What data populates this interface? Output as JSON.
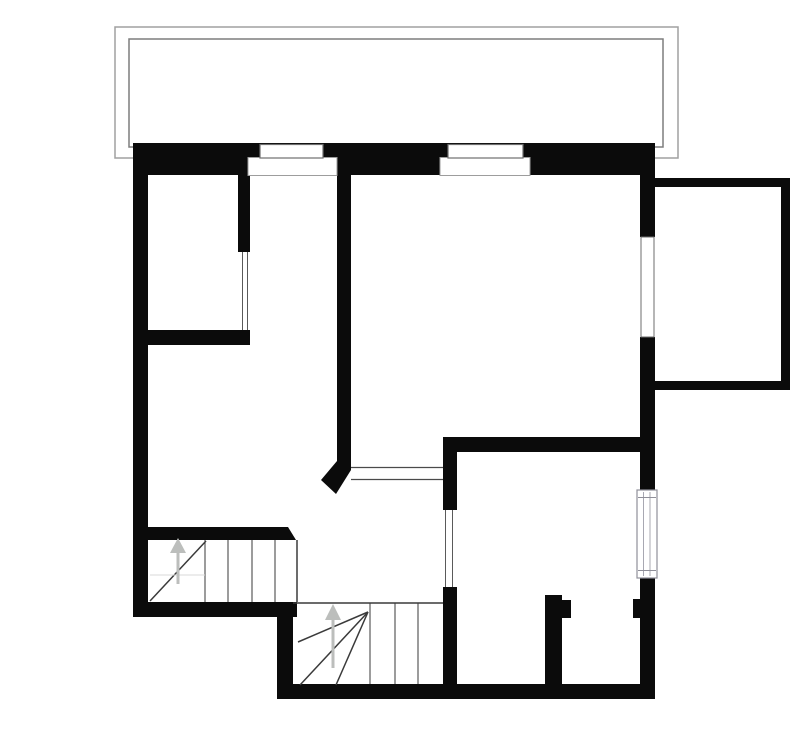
{
  "canvas": {
    "width": 800,
    "height": 736,
    "background": "#ffffff"
  },
  "colors": {
    "wall": "#0b0b0b",
    "white": "#ffffff",
    "terrace_outer": "#a0a0a0",
    "terrace_inner": "#7d7d7d",
    "window_line": "#6e6e6e",
    "recess_line": "#9d9d9d",
    "opening_line": "#5a5a5a",
    "door_line": "#4a4a4a",
    "tread": "#3a3a3a",
    "faint": "#d8d8d8",
    "arrow": "#bcbebc",
    "radiator_border": "#8f8f99",
    "radiator_line": "#a8a8b2"
  },
  "elements": [
    {
      "type": "rect",
      "name": "terrace-outer-rect",
      "x": 115,
      "y": 27,
      "w": 563,
      "h": 131,
      "fill": "none",
      "stroke": "terrace_outer",
      "sw": 1.5
    },
    {
      "type": "rect",
      "name": "terrace-inner-rect",
      "x": 129,
      "y": 39,
      "w": 534,
      "h": 108,
      "fill": "none",
      "stroke": "terrace_inner",
      "sw": 1.5
    },
    {
      "type": "rect",
      "name": "top-wall",
      "x": 133,
      "y": 143,
      "w": 522,
      "h": 32,
      "fill": "wall"
    },
    {
      "type": "rect",
      "name": "left-wall",
      "x": 133,
      "y": 143,
      "w": 15,
      "h": 474,
      "fill": "wall"
    },
    {
      "type": "rect",
      "name": "bottom-left-wall",
      "x": 133,
      "y": 602,
      "w": 164,
      "h": 15,
      "fill": "wall"
    },
    {
      "type": "rect",
      "name": "stair-step-wall",
      "x": 277,
      "y": 602,
      "w": 16,
      "h": 97,
      "fill": "wall"
    },
    {
      "type": "rect",
      "name": "bottom-wall",
      "x": 277,
      "y": 684,
      "w": 378,
      "h": 15,
      "fill": "wall"
    },
    {
      "type": "rect",
      "name": "right-wall-upper",
      "x": 640,
      "y": 143,
      "w": 15,
      "h": 94,
      "fill": "wall"
    },
    {
      "type": "rect",
      "name": "right-wall-mid",
      "x": 640,
      "y": 337,
      "w": 15,
      "h": 153,
      "fill": "wall"
    },
    {
      "type": "rect",
      "name": "right-wall-lower",
      "x": 640,
      "y": 578,
      "w": 15,
      "h": 121,
      "fill": "wall"
    },
    {
      "type": "rect",
      "name": "balcony-top-wall",
      "x": 653,
      "y": 178,
      "w": 137,
      "h": 9,
      "fill": "wall"
    },
    {
      "type": "rect",
      "name": "balcony-right-wall",
      "x": 781,
      "y": 178,
      "w": 9,
      "h": 212,
      "fill": "wall"
    },
    {
      "type": "rect",
      "name": "balcony-bottom-wall",
      "x": 653,
      "y": 381,
      "w": 137,
      "h": 9,
      "fill": "wall"
    },
    {
      "type": "rect",
      "name": "bedroom-divider-wall",
      "x": 238,
      "y": 158,
      "w": 12,
      "h": 94,
      "fill": "wall"
    },
    {
      "type": "rect",
      "name": "bedroom-bottom-wall",
      "x": 148,
      "y": 330,
      "w": 102,
      "h": 15,
      "fill": "wall"
    },
    {
      "type": "rect",
      "name": "center-wall",
      "x": 337,
      "y": 143,
      "w": 14,
      "h": 324,
      "fill": "wall"
    },
    {
      "type": "rect",
      "name": "room2-top-wall",
      "x": 443,
      "y": 437,
      "w": 212,
      "h": 15,
      "fill": "wall"
    },
    {
      "type": "rect",
      "name": "room2-left-wall-upper",
      "x": 443,
      "y": 437,
      "w": 14,
      "h": 73,
      "fill": "wall"
    },
    {
      "type": "rect",
      "name": "room2-left-wall-lower",
      "x": 443,
      "y": 587,
      "w": 14,
      "h": 112,
      "fill": "wall"
    },
    {
      "type": "rect",
      "name": "stair-side-wall",
      "x": 148,
      "y": 527,
      "w": 130,
      "h": 13,
      "fill": "wall"
    },
    {
      "type": "rect",
      "name": "room2-stub-wall",
      "x": 545,
      "y": 595,
      "w": 17,
      "h": 101,
      "fill": "wall"
    },
    {
      "type": "rect",
      "name": "room2-stub-notch",
      "x": 562,
      "y": 600,
      "w": 9,
      "h": 18,
      "fill": "wall"
    },
    {
      "type": "rect",
      "name": "right-wall-stub",
      "x": 633,
      "y": 599,
      "w": 9,
      "h": 19,
      "fill": "wall"
    },
    {
      "type": "polygon",
      "name": "center-wall-tip",
      "points": "337,461 351,461 351,470 336,494 321,480",
      "fill": "wall"
    },
    {
      "type": "polygon",
      "name": "stair-side-wall-end",
      "points": "278,527 288,527 296,540 278,540",
      "fill": "wall"
    },
    {
      "type": "rect",
      "name": "window1-recess",
      "x": 248,
      "y": 157.5,
      "w": 89,
      "h": 18,
      "fill": "white",
      "stroke": "recess_line",
      "sw": 1
    },
    {
      "type": "rect",
      "name": "window1",
      "x": 260,
      "y": 144.5,
      "w": 63,
      "h": 13.5,
      "fill": "white",
      "stroke": "window_line",
      "sw": 1.2
    },
    {
      "type": "rect",
      "name": "window2-recess",
      "x": 440,
      "y": 157.5,
      "w": 90,
      "h": 18,
      "fill": "white",
      "stroke": "recess_line",
      "sw": 1
    },
    {
      "type": "rect",
      "name": "window2",
      "x": 448,
      "y": 144.5,
      "w": 75,
      "h": 13.5,
      "fill": "white",
      "stroke": "window_line",
      "sw": 1.2
    },
    {
      "type": "rect",
      "name": "window3",
      "x": 641,
      "y": 237,
      "w": 13,
      "h": 100,
      "fill": "white",
      "stroke": "window_line",
      "sw": 1
    },
    {
      "type": "rect",
      "name": "radiator-window",
      "x": 637,
      "y": 490,
      "w": 20,
      "h": 88,
      "fill": "white",
      "stroke": "radiator_border",
      "sw": 1.2
    },
    {
      "type": "line",
      "name": "radiator-line-left",
      "x1": 643.5,
      "y1": 492,
      "x2": 643.5,
      "y2": 576,
      "stroke": "radiator_line",
      "sw": 1
    },
    {
      "type": "line",
      "name": "radiator-line-right",
      "x1": 650,
      "y1": 492,
      "x2": 650,
      "y2": 576,
      "stroke": "radiator_line",
      "sw": 1
    },
    {
      "type": "line",
      "name": "radiator-cap-top",
      "x1": 638,
      "y1": 497.5,
      "x2": 656,
      "y2": 497.5,
      "stroke": "radiator_border",
      "sw": 1
    },
    {
      "type": "line",
      "name": "radiator-cap-bottom",
      "x1": 638,
      "y1": 570.5,
      "x2": 656,
      "y2": 570.5,
      "stroke": "radiator_border",
      "sw": 1
    },
    {
      "type": "line",
      "name": "glazing-line-1",
      "x1": 242.5,
      "y1": 252,
      "x2": 242.5,
      "y2": 330,
      "stroke": "opening_line",
      "sw": 1
    },
    {
      "type": "line",
      "name": "glazing-line-2",
      "x1": 247.5,
      "y1": 252,
      "x2": 247.5,
      "y2": 330,
      "stroke": "opening_line",
      "sw": 1
    },
    {
      "type": "line",
      "name": "room2-opening-line-1",
      "x1": 445.5,
      "y1": 510,
      "x2": 445.5,
      "y2": 587,
      "stroke": "opening_line",
      "sw": 1
    },
    {
      "type": "line",
      "name": "room2-opening-line-2",
      "x1": 452.5,
      "y1": 510,
      "x2": 452.5,
      "y2": 587,
      "stroke": "opening_line",
      "sw": 1
    },
    {
      "type": "line",
      "name": "door-opening-line-top",
      "x1": 351,
      "y1": 467.5,
      "x2": 443,
      "y2": 467.5,
      "stroke": "door_line",
      "sw": 1.2
    },
    {
      "type": "line",
      "name": "door-opening-line-bottom",
      "x1": 351,
      "y1": 479.5,
      "x2": 443,
      "y2": 479.5,
      "stroke": "door_line",
      "sw": 1.2
    },
    {
      "type": "line",
      "name": "stair1-tread-1",
      "x1": 205,
      "y1": 540,
      "x2": 205,
      "y2": 602,
      "stroke": "tread",
      "sw": 1
    },
    {
      "type": "line",
      "name": "stair1-tread-2",
      "x1": 228,
      "y1": 540,
      "x2": 228,
      "y2": 602,
      "stroke": "tread",
      "sw": 1
    },
    {
      "type": "line",
      "name": "stair1-tread-3",
      "x1": 252,
      "y1": 540,
      "x2": 252,
      "y2": 602,
      "stroke": "tread",
      "sw": 1
    },
    {
      "type": "line",
      "name": "stair1-tread-4",
      "x1": 275,
      "y1": 540,
      "x2": 275,
      "y2": 602,
      "stroke": "tread",
      "sw": 1
    },
    {
      "type": "line",
      "name": "stair1-edge",
      "x1": 297,
      "y1": 540,
      "x2": 297,
      "y2": 602,
      "stroke": "tread",
      "sw": 1.5
    },
    {
      "type": "line",
      "name": "stair1-diagonal",
      "x1": 150,
      "y1": 601,
      "x2": 206,
      "y2": 541,
      "stroke": "tread",
      "sw": 1.5
    },
    {
      "type": "line",
      "name": "stair1-faint-line",
      "x1": 150,
      "y1": 575,
      "x2": 205,
      "y2": 575,
      "stroke": "faint",
      "sw": 1
    },
    {
      "type": "line",
      "name": "stair1-arrow-shaft",
      "x1": 178,
      "y1": 584,
      "x2": 178,
      "y2": 551,
      "stroke": "arrow",
      "sw": 3
    },
    {
      "type": "polygon",
      "name": "stair1-arrow-head",
      "points": "170,553 186,553 178,538",
      "fill": "arrow"
    },
    {
      "type": "line",
      "name": "stair2-top-edge",
      "x1": 293,
      "y1": 603,
      "x2": 443,
      "y2": 603,
      "stroke": "tread",
      "sw": 1.5
    },
    {
      "type": "line",
      "name": "stair2-tread-1",
      "x1": 370,
      "y1": 603,
      "x2": 370,
      "y2": 684,
      "stroke": "tread",
      "sw": 1
    },
    {
      "type": "line",
      "name": "stair2-tread-2",
      "x1": 395,
      "y1": 603,
      "x2": 395,
      "y2": 684,
      "stroke": "tread",
      "sw": 1
    },
    {
      "type": "line",
      "name": "stair2-tread-3",
      "x1": 418,
      "y1": 603,
      "x2": 418,
      "y2": 684,
      "stroke": "tread",
      "sw": 1
    },
    {
      "type": "line",
      "name": "stair2-winder-line-1",
      "x1": 368,
      "y1": 612,
      "x2": 298,
      "y2": 642,
      "stroke": "tread",
      "sw": 1.5
    },
    {
      "type": "line",
      "name": "stair2-winder-line-2",
      "x1": 368,
      "y1": 612,
      "x2": 300,
      "y2": 685,
      "stroke": "tread",
      "sw": 1.5
    },
    {
      "type": "line",
      "name": "stair2-winder-line-3",
      "x1": 368,
      "y1": 612,
      "x2": 336,
      "y2": 685,
      "stroke": "tread",
      "sw": 1.5
    },
    {
      "type": "line",
      "name": "stair2-arrow-shaft",
      "x1": 333,
      "y1": 668,
      "x2": 333,
      "y2": 618,
      "stroke": "arrow",
      "sw": 3
    },
    {
      "type": "polygon",
      "name": "stair2-arrow-head",
      "points": "325,620 341,620 333,604",
      "fill": "arrow"
    }
  ]
}
